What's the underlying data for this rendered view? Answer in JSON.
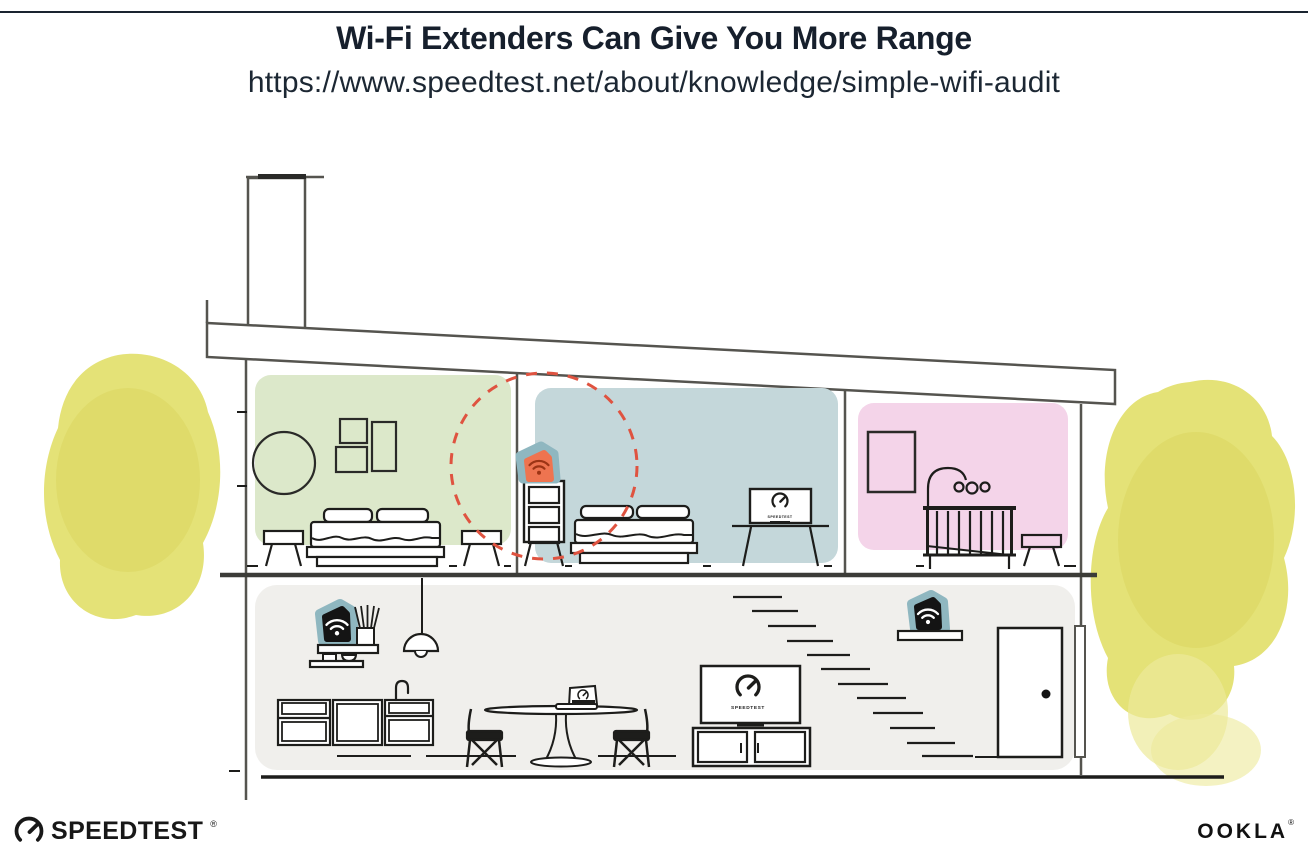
{
  "header": {
    "title": "Wi-Fi Extenders Can Give You More Range",
    "url": "https://www.speedtest.net/about/knowledge/simple-wifi-audit"
  },
  "illustration": {
    "screen_label": "SPEEDTEST",
    "colors": {
      "room_green": "#dce8ca",
      "room_blue": "#c4d7da",
      "room_pink": "#f4d4e9",
      "room_gray": "#f0efec",
      "device_teal": "#8fb7c0",
      "extender_orange": "#ee7450",
      "extender_wifi": "#9c3415",
      "range_dash": "#df5340",
      "foliage": "#e2df6b",
      "foliage_light": "#ecea9a",
      "foliage_dark": "#d6d258",
      "wall_gray": "#55544f",
      "line_dark": "#1d1d1b"
    },
    "icons": {
      "wifi": "wifi-icon (dot with two arcs)",
      "gauge": "speedtest-gauge-icon (open ring with needle)"
    }
  },
  "footer": {
    "speedtest_wordmark": "SPEEDTEST",
    "speedtest_reg": "®",
    "ookla_wordmark": "OOKLA",
    "ookla_reg": "®"
  }
}
